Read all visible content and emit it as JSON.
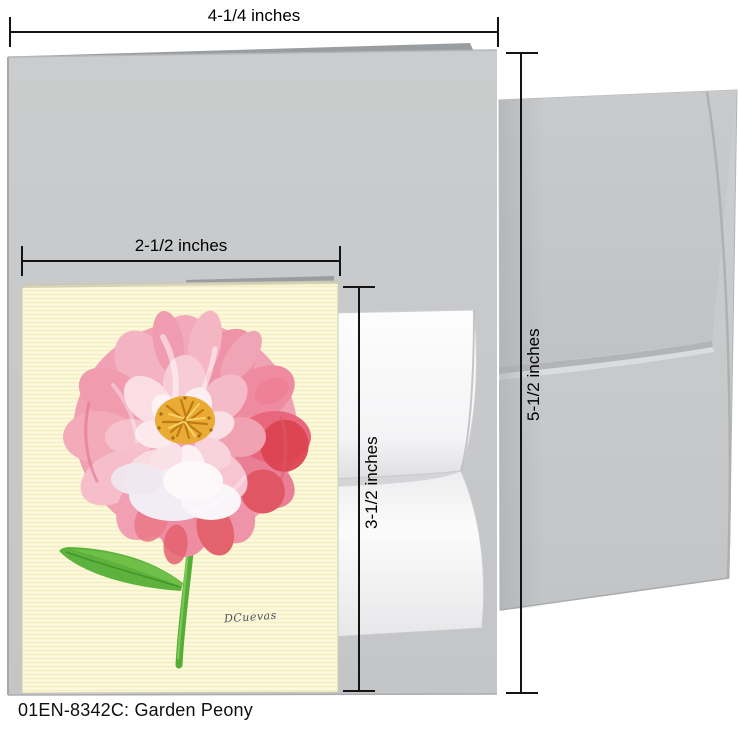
{
  "caption": "01EN-8342C: Garden Peony",
  "dimensions": {
    "large_card_width": "4-1/4 inches",
    "large_card_height": "5-1/2 inches",
    "small_card_width": "2-1/2 inches",
    "small_card_height": "3-1/2 inches"
  },
  "artwork": {
    "signature": "DCuevas"
  },
  "colors": {
    "background": "#ffffff",
    "large_card_gray": "#c7c9cb",
    "card_back_edge_gray": "#9a9da0",
    "envelope_gray": "#c9cbcd",
    "inner_note_white": "#fafafa",
    "small_card_cream": "#faf6d3",
    "petal_pink": "#f09fb1",
    "petal_deep_red": "#dc4350",
    "flower_center_gold": "#e9ab33",
    "stem_green": "#55ad35",
    "dimension_line_black": "#141414"
  }
}
